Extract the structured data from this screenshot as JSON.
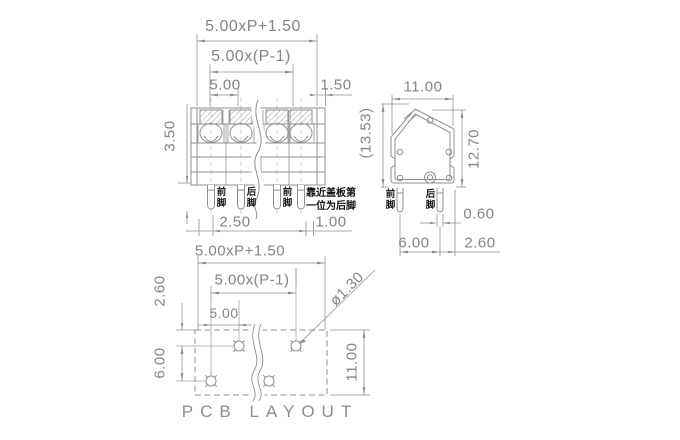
{
  "drawing": {
    "front_view": {
      "dims": {
        "overall_width": "5.00xP+1.50",
        "pitch_span": "5.00x(P-1)",
        "pitch": "5.00",
        "end_margin": "1.50",
        "body_height": "3.50",
        "edge_to_pin": "2.50",
        "last_pin_offset": "1.00"
      },
      "pin_labels": [
        "前脚",
        "后脚",
        "前脚"
      ],
      "note_line1": "靠近盖板第",
      "note_line2": "一位为后脚"
    },
    "side_view": {
      "dims": {
        "width": "11.00",
        "total_height": "(13.53)",
        "height": "12.70",
        "pin_width": "0.60",
        "pin_row_spacing": "6.00",
        "pin_to_edge": "2.60"
      },
      "pin_labels": [
        "前脚",
        "后脚"
      ]
    },
    "pcb_layout": {
      "title": "PCB LAYOUT",
      "dims": {
        "overall_width": "5.00xP+1.50",
        "pitch_span": "5.00x(P-1)",
        "pitch": "5.00",
        "edge_to_row": "2.60",
        "row_spacing": "6.00",
        "board_height": "11.00",
        "hole_diameter": "ø1.30"
      }
    },
    "colors": {
      "line": "#8f8f8f",
      "dim_text": "#848484",
      "note_text": "#161616",
      "background": "#ffffff"
    }
  }
}
